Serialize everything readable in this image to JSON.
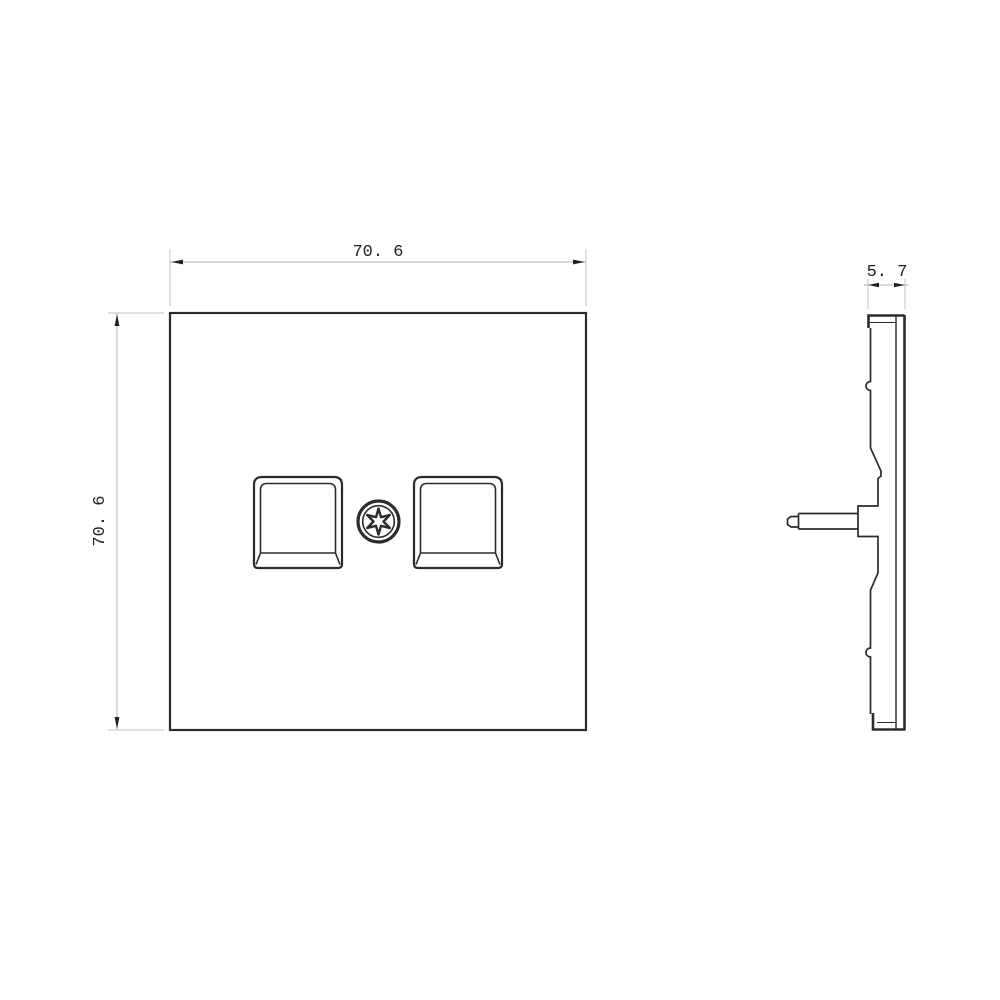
{
  "colors": {
    "background": "#ffffff",
    "object_line": "#2b2b2b",
    "dimension_line": "#b4b4b4",
    "dimension_text": "#222222"
  },
  "front_view": {
    "width_label": "70. 6",
    "height_label": "70. 6"
  },
  "side_view": {
    "thickness_label": "5. 7"
  }
}
